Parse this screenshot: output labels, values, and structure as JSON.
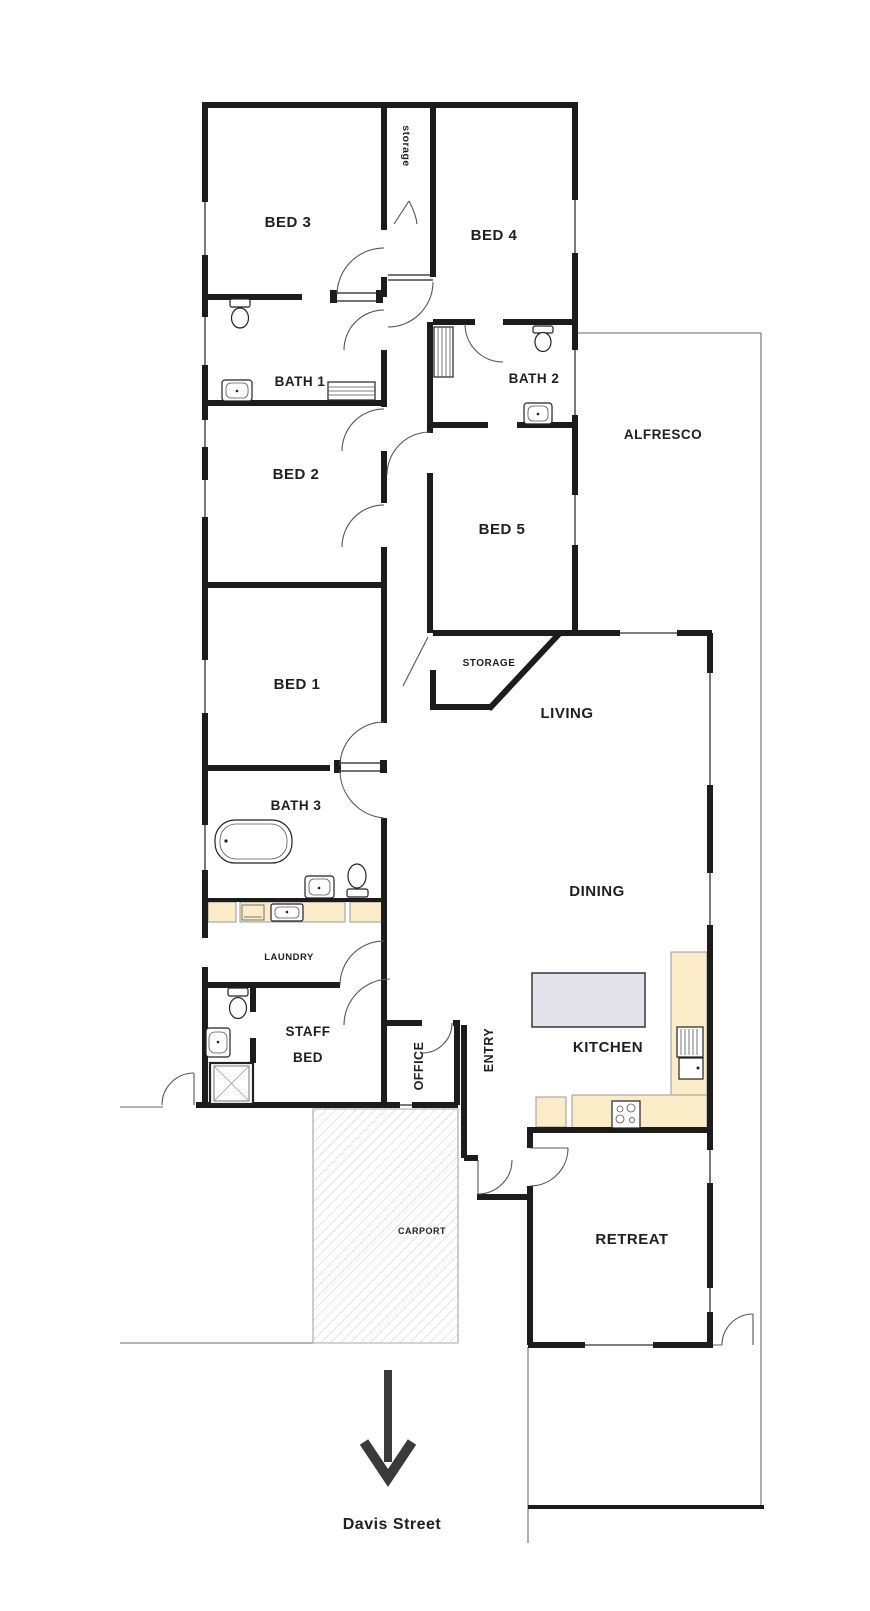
{
  "plan_title": "Residential floor plan",
  "colors": {
    "wall": "#1c1c1c",
    "counter": "#f9ecc7",
    "island": "#e4e3eb",
    "hatch": "#c9c9c9",
    "arrow": "#3a3a3a"
  },
  "street": {
    "label": "Davis Street"
  },
  "labels": [
    {
      "id": "bed3",
      "text": "BED 3",
      "x": 288,
      "y": 227,
      "fs": 15,
      "rot": 0
    },
    {
      "id": "bed4",
      "text": "BED 4",
      "x": 494,
      "y": 240,
      "fs": 15,
      "rot": 0
    },
    {
      "id": "storage-top",
      "text": "storage",
      "x": 403,
      "y": 146,
      "fs": 10.5,
      "rot": 90
    },
    {
      "id": "bath1",
      "text": "BATH 1",
      "x": 300,
      "y": 386,
      "fs": 13.5,
      "rot": 0
    },
    {
      "id": "bath2",
      "text": "BATH 2",
      "x": 534,
      "y": 383,
      "fs": 13.5,
      "rot": 0
    },
    {
      "id": "alfresco",
      "text": "ALFRESCO",
      "x": 663,
      "y": 439,
      "fs": 13.5,
      "rot": 0
    },
    {
      "id": "bed2",
      "text": "BED 2",
      "x": 296,
      "y": 479,
      "fs": 15,
      "rot": 0
    },
    {
      "id": "bed5",
      "text": "BED 5",
      "x": 502,
      "y": 534,
      "fs": 15,
      "rot": 0
    },
    {
      "id": "bed1",
      "text": "BED 1",
      "x": 297,
      "y": 689,
      "fs": 15,
      "rot": 0
    },
    {
      "id": "storage-mid",
      "text": "STORAGE",
      "x": 489,
      "y": 666,
      "fs": 10,
      "rot": 0
    },
    {
      "id": "living",
      "text": "LIVING",
      "x": 567,
      "y": 718,
      "fs": 15,
      "rot": 0
    },
    {
      "id": "bath3",
      "text": "BATH 3",
      "x": 296,
      "y": 810,
      "fs": 13.5,
      "rot": 0
    },
    {
      "id": "dining",
      "text": "DINING",
      "x": 597,
      "y": 896,
      "fs": 15,
      "rot": 0
    },
    {
      "id": "laundry",
      "text": "LAUNDRY",
      "x": 289,
      "y": 960,
      "fs": 9.5,
      "rot": 0
    },
    {
      "id": "staff-bed-1",
      "text": "STAFF",
      "x": 308,
      "y": 1036,
      "fs": 13.5,
      "rot": 0
    },
    {
      "id": "staff-bed-2",
      "text": "BED",
      "x": 308,
      "y": 1062,
      "fs": 13.5,
      "rot": 0
    },
    {
      "id": "office",
      "text": "OFFICE",
      "x": 423,
      "y": 1066,
      "fs": 12.5,
      "rot": -90
    },
    {
      "id": "entry",
      "text": "ENTRY",
      "x": 493,
      "y": 1050,
      "fs": 12.5,
      "rot": -90
    },
    {
      "id": "kitchen",
      "text": "KITCHEN",
      "x": 608,
      "y": 1052,
      "fs": 15,
      "rot": 0
    },
    {
      "id": "carport",
      "text": "CARPORT",
      "x": 422,
      "y": 1234,
      "fs": 9,
      "rot": 0
    },
    {
      "id": "retreat",
      "text": "RETREAT",
      "x": 632,
      "y": 1244,
      "fs": 15,
      "rot": 0
    },
    {
      "id": "street",
      "text": "Davis Street",
      "x": 392,
      "y": 1529,
      "fs": 16,
      "rot": 0
    }
  ]
}
